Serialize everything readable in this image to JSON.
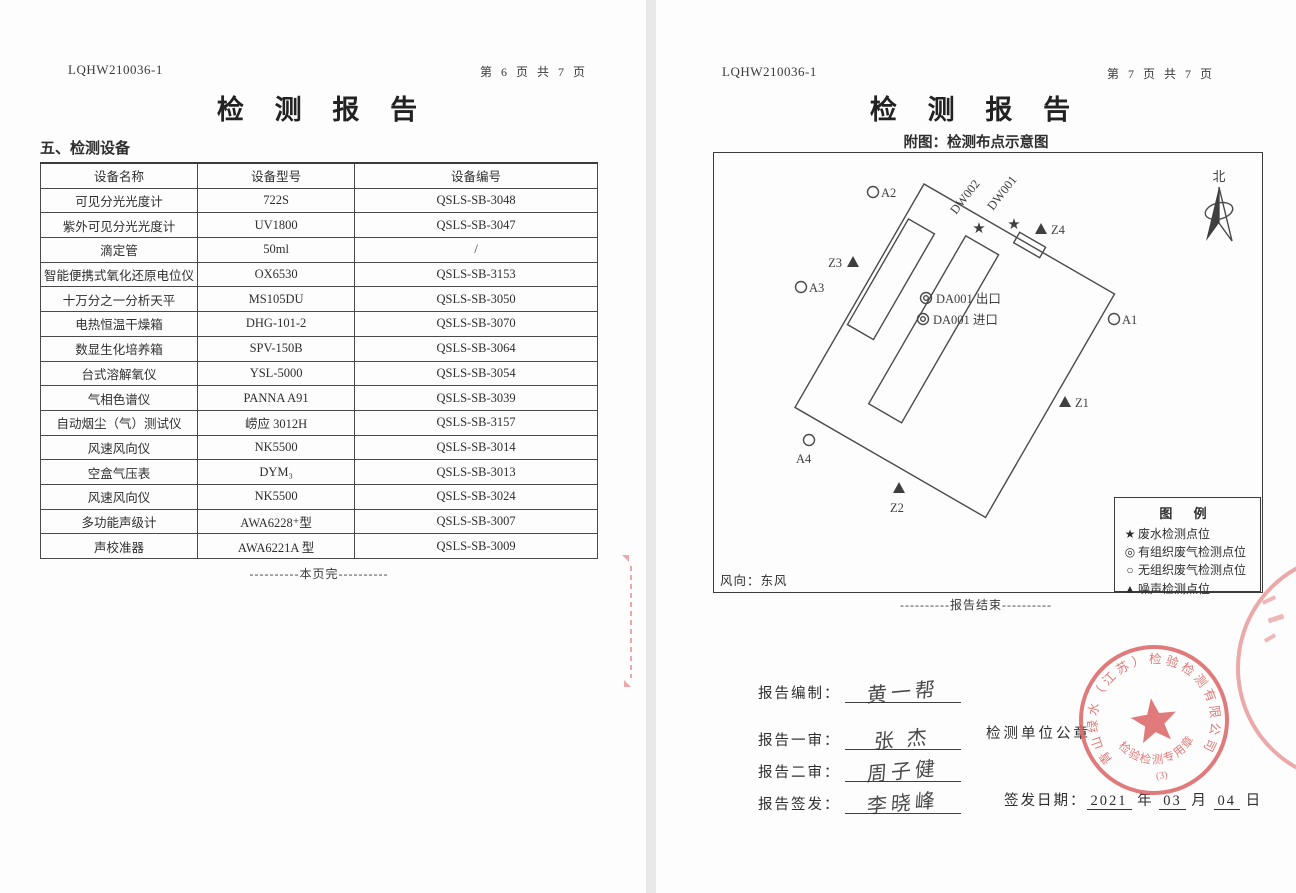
{
  "colors": {
    "stamp_red": "#dd6464",
    "ink": "#2e2e2e",
    "diagram_line": "#4a4a4a"
  },
  "pages": {
    "left": {
      "doc_no": "LQHW210036-1",
      "page_no": "第 6 页 共 7 页",
      "title": "检 测 报 告",
      "section_heading": "五、检测设备",
      "table": {
        "headers": [
          "设备名称",
          "设备型号",
          "设备编号"
        ],
        "rows": [
          [
            "可见分光光度计",
            "722S",
            "QSLS-SB-3048"
          ],
          [
            "紫外可见分光光度计",
            "UV1800",
            "QSLS-SB-3047"
          ],
          [
            "滴定管",
            "50ml",
            "/"
          ],
          [
            "智能便携式氧化还原电位仪",
            "OX6530",
            "QSLS-SB-3153"
          ],
          [
            "十万分之一分析天平",
            "MS105DU",
            "QSLS-SB-3050"
          ],
          [
            "电热恒温干燥箱",
            "DHG-101-2",
            "QSLS-SB-3070"
          ],
          [
            "数显生化培养箱",
            "SPV-150B",
            "QSLS-SB-3064"
          ],
          [
            "台式溶解氧仪",
            "YSL-5000",
            "QSLS-SB-3054"
          ],
          [
            "气相色谱仪",
            "PANNA A91",
            "QSLS-SB-3039"
          ],
          [
            "自动烟尘（气）测试仪",
            "崂应 3012H",
            "QSLS-SB-3157"
          ],
          [
            "风速风向仪",
            "NK5500",
            "QSLS-SB-3014"
          ],
          [
            "空盒气压表",
            "DYM₃",
            "QSLS-SB-3013"
          ],
          [
            "风速风向仪",
            "NK5500",
            "QSLS-SB-3024"
          ],
          [
            "多功能声级计",
            "AWA6228⁺型",
            "QSLS-SB-3007"
          ],
          [
            "声校准器",
            "AWA6221A 型",
            "QSLS-SB-3009"
          ]
        ]
      },
      "footer_note": "----------本页完----------"
    },
    "right": {
      "doc_no": "LQHW210036-1",
      "page_no": "第 7 页 共 7 页",
      "title": "检 测 报 告",
      "subtitle": "附图：检测布点示意图",
      "diagram": {
        "north_label": "北",
        "wind_label": "风向：东风",
        "labels": {
          "a1": "A1",
          "a2": "A2",
          "a3": "A3",
          "a4": "A4",
          "z1": "Z1",
          "z2": "Z2",
          "z3": "Z3",
          "z4": "Z4",
          "dw001": "DW001",
          "dw002": "DW002",
          "da001_out": "DA001 出口",
          "da001_in": "DA001 进口"
        },
        "legend": {
          "title": "图  例",
          "items": [
            {
              "symbol": "★",
              "label": "废水检测点位"
            },
            {
              "symbol": "◎",
              "label": "有组织废气检测点位"
            },
            {
              "symbol": "○",
              "label": "无组织废气检测点位"
            },
            {
              "symbol": "▲",
              "label": "噪声检测点位"
            }
          ]
        }
      },
      "end_note": "----------报告结束----------",
      "signoff": {
        "rows": [
          {
            "label": "报告编制：",
            "signature": "黄一帮"
          },
          {
            "label": "报告一审：",
            "signature": "张 杰"
          },
          {
            "label": "报告二审：",
            "signature": "周子健"
          },
          {
            "label": "报告签发：",
            "signature": "李晓峰"
          }
        ],
        "seal_caption": "检测单位公章",
        "date": {
          "label": "签发日期：",
          "year": "2021",
          "year_unit": "年",
          "month": "03",
          "month_unit": "月",
          "day": "04",
          "day_unit": "日"
        }
      },
      "stamp": {
        "company": "青山绿水（江苏）检验检测有限公司",
        "type_text": "检验检测专用章",
        "number": "(3)"
      }
    }
  }
}
